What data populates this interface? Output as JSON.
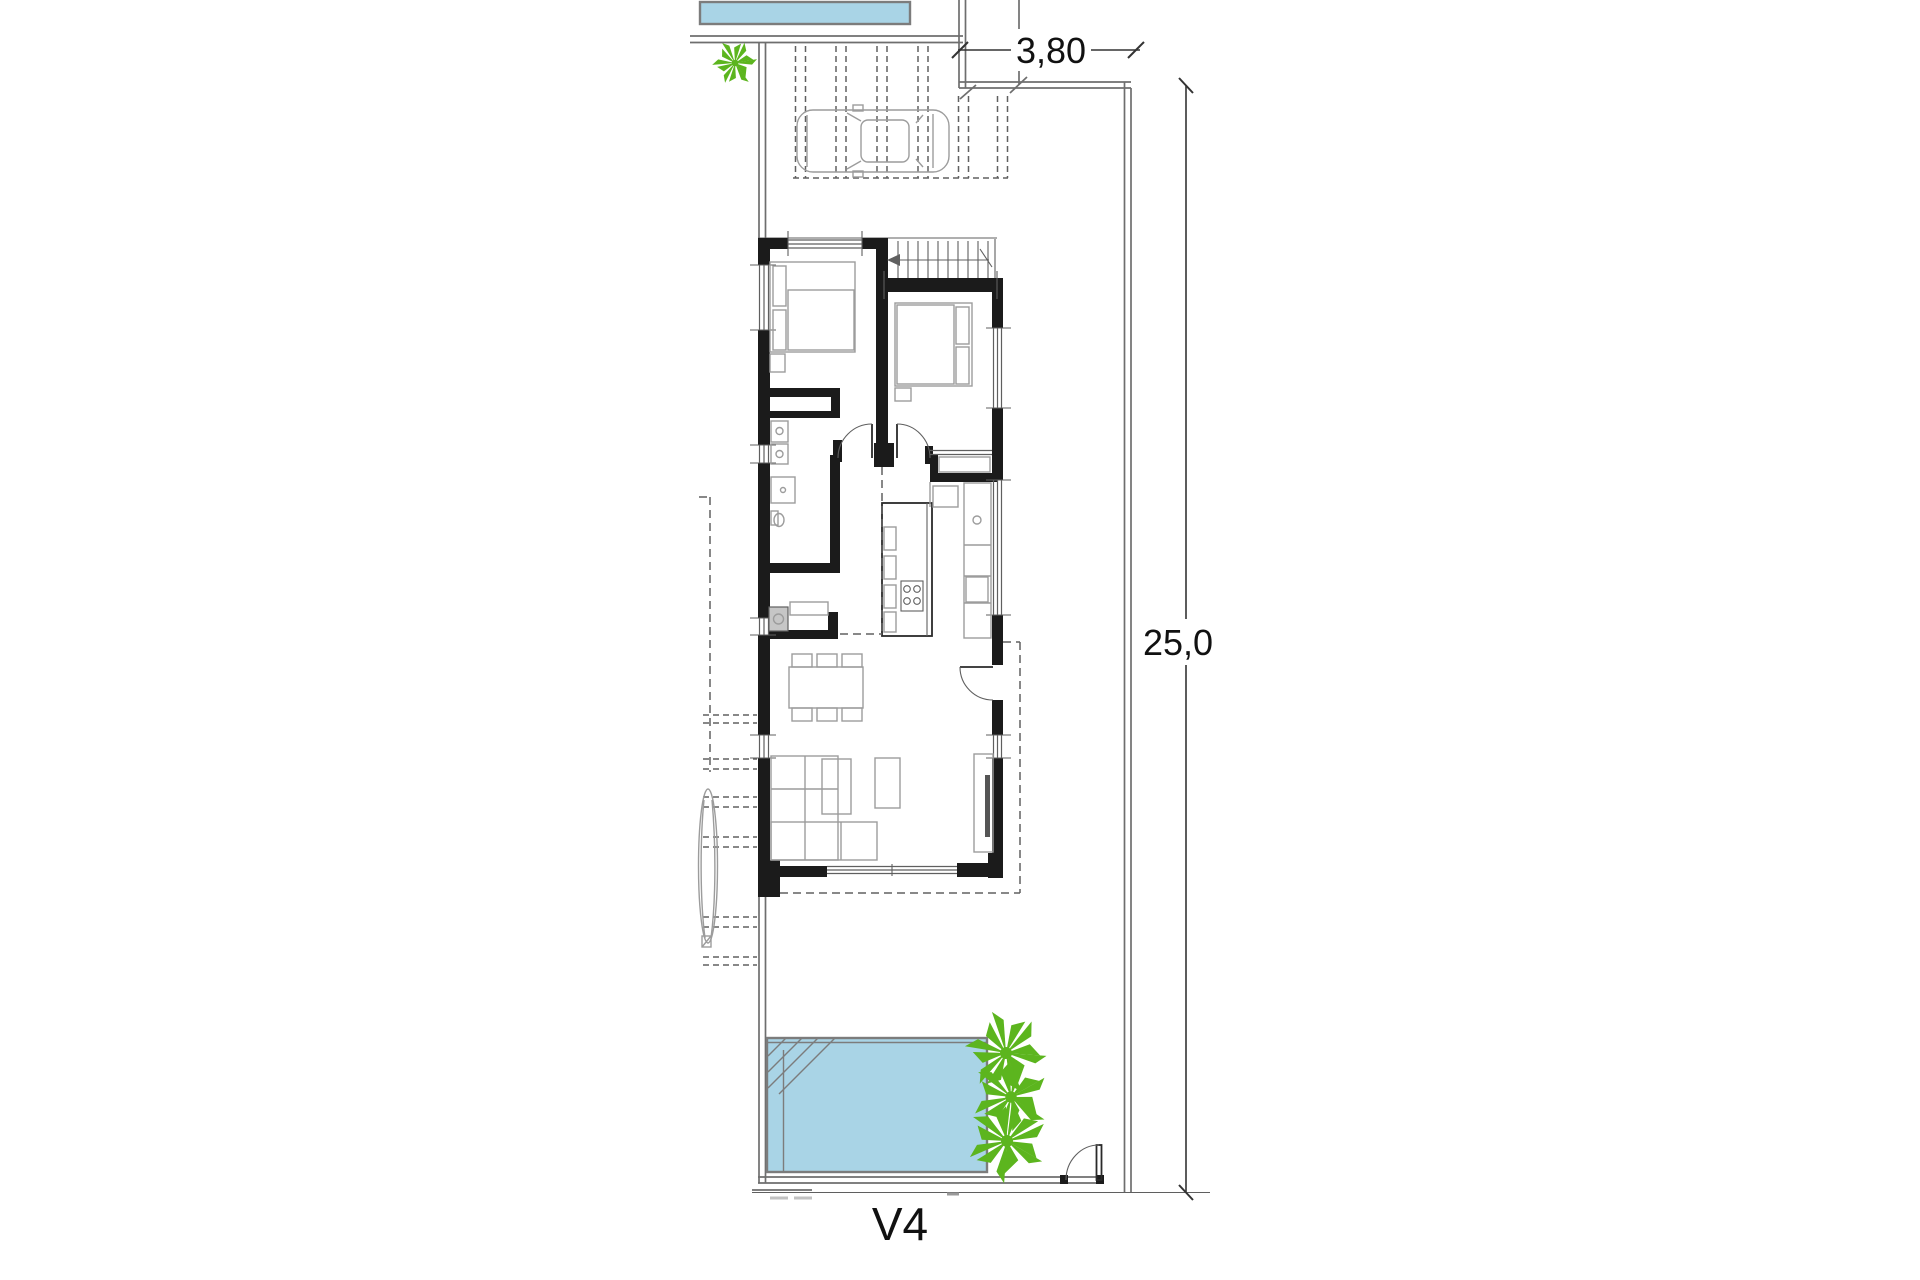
{
  "drawing": {
    "type": "architectural-floor-plan",
    "unit_label": "V4",
    "dimensions": {
      "plot_width_label": "3,80",
      "plot_depth_label": "25,0"
    },
    "colors": {
      "background": "#ffffff",
      "wall": "#1b1b1b",
      "line": "#5f5f5f",
      "light_line": "#9c9c9c",
      "boundary": "#6e6e6e",
      "dashed_line": "#606060",
      "pool_fill": "#a9d4e6",
      "pool_border": "#7c7c7c",
      "palm_green": "#5cb51e",
      "dim_text": "#111111"
    },
    "elements": [
      "neighbor-pool",
      "site-boundary",
      "palm-tree",
      "carport-pergola",
      "car",
      "staircase",
      "bedroom-bed",
      "bathroom-fixtures",
      "laundry-washer",
      "kitchen-island",
      "dining-table",
      "sofa",
      "coffee-table",
      "armchair",
      "tv-console",
      "terrace-steps",
      "garden-tree",
      "swimming-pool",
      "garden-gate-door",
      "entrance-door",
      "width-dimension",
      "depth-dimension",
      "unit-label"
    ]
  }
}
